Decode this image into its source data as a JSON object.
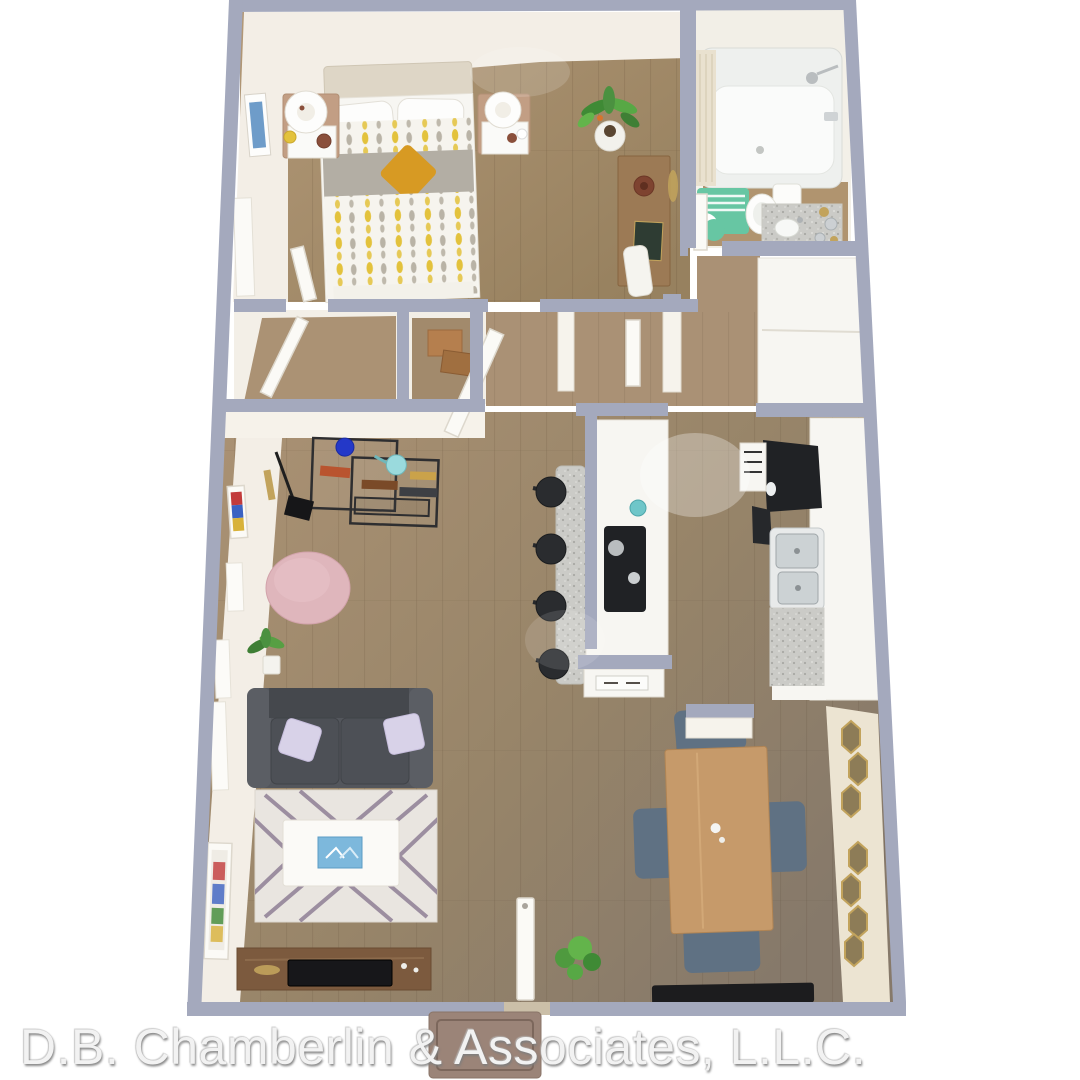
{
  "watermark": {
    "text": "D.B. Chamberlin & Associates, L.L.C."
  },
  "scene": {
    "type": "3d-floor-plan-rendering",
    "rooms": [
      "bedroom",
      "bathroom",
      "closets",
      "hallway",
      "kitchen",
      "living-room",
      "dining-area",
      "entry"
    ],
    "furniture": [
      "bed",
      "nightstands",
      "lamps",
      "desk",
      "bathtub",
      "toilet",
      "vanity",
      "kitchen-island",
      "bar-stools",
      "refrigerator",
      "sink",
      "sofa",
      "area-rug",
      "coffee-table",
      "pouf",
      "etagere",
      "floor-lamp",
      "tv-console",
      "dining-table",
      "dining-chairs",
      "hexagon-mirrors",
      "door-mats",
      "plants"
    ]
  },
  "colors": {
    "wall": "#a4a9bd",
    "wall_face": "#f3eee6",
    "counter": "#f7f6f2",
    "appliance": "#202225",
    "sofa": "#53565c",
    "rug": "#e9e5e0",
    "rug_stripe": "#8f7f95",
    "pouf": "#dfb6bc",
    "table_wood": "#c69a6a",
    "chair": "#5f7183",
    "accent_teal": "#67c6a3",
    "accent_mustard": "#d79a23",
    "accent_yellow": "#e3c23c",
    "plant": "#4f9a3f",
    "gold": "#c2a35c",
    "mat_dark": "#1c1c1e",
    "mat_outdoor": "#9b8478",
    "floor_wood": "#a78e6f",
    "floor_wood_dark": "#8b7a64",
    "floor_bath": "#b0946f",
    "watermark": "#f2f2f2"
  }
}
